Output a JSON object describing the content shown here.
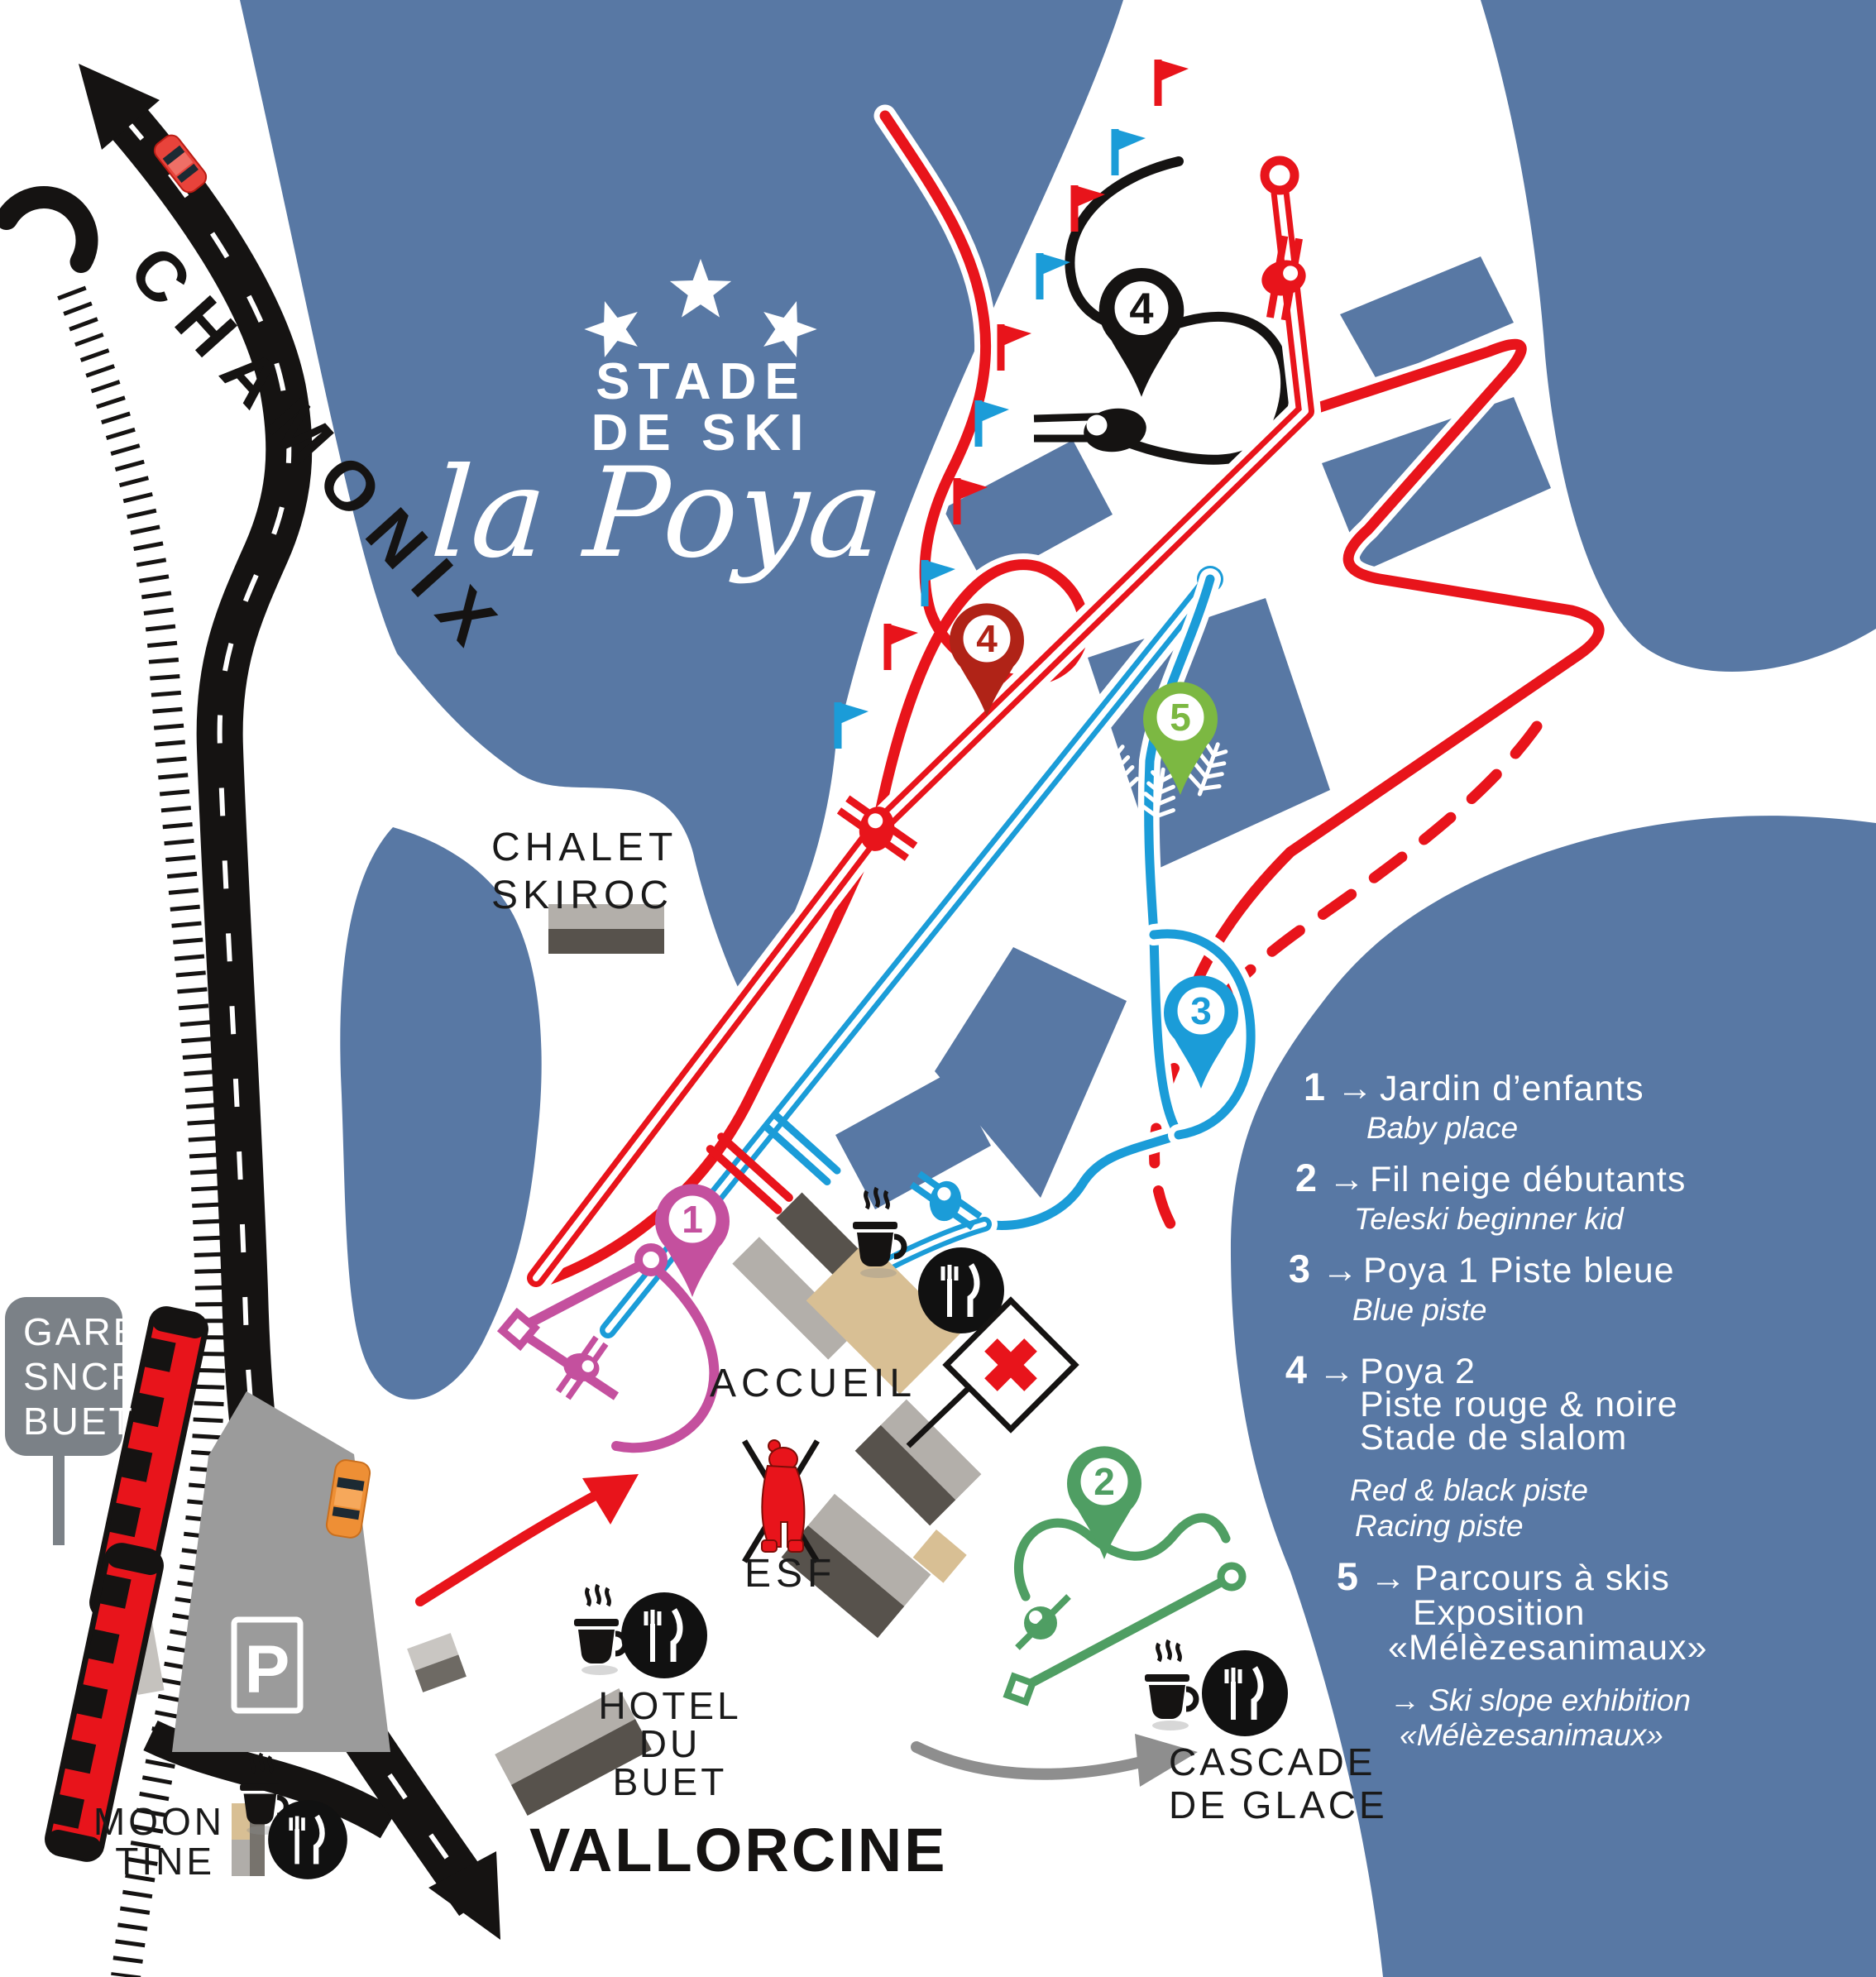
{
  "title": {
    "stars_count": "3",
    "line1": "STADE",
    "line2": "DE SKI",
    "script": "la Poya"
  },
  "nav": {
    "chamonix": "CHAMONIX",
    "vallorcine": "VALLORCINE"
  },
  "sign_gare": {
    "lines": [
      "GARE",
      "SNCF",
      "BUET"
    ]
  },
  "places": {
    "chalet_skiroc": {
      "line1": "CHALET",
      "line2": "SKIROC"
    },
    "accueil": "ACCUEIL",
    "esf": "ESF",
    "hotel_du_buet": {
      "line1": "HOTEL",
      "line2": "DU",
      "line3": "BUET"
    },
    "moontine": {
      "line1": "MOON",
      "line2": "TINE"
    },
    "cascade_de_glace": {
      "line1": "CASCADE",
      "line2": "DE GLACE"
    },
    "parking": "P"
  },
  "markers": {
    "m1": {
      "number": "1",
      "color": "#c4509e"
    },
    "m2": {
      "number": "2",
      "color": "#4f9e63"
    },
    "m3": {
      "number": "3",
      "color": "#1b9cd8"
    },
    "m4_red": {
      "number": "4",
      "color": "#b02317"
    },
    "m4_black": {
      "number": "4",
      "color": "#151312"
    },
    "m5": {
      "number": "5",
      "color": "#7cb842"
    }
  },
  "legend": {
    "arrow": "→",
    "items": [
      {
        "number": "1",
        "fr": [
          "Jardin d’enfants"
        ],
        "en": [
          "Baby place"
        ]
      },
      {
        "number": "2",
        "fr": [
          "Fil neige débutants"
        ],
        "en": [
          "Teleski beginner kid"
        ]
      },
      {
        "number": "3",
        "fr": [
          "Poya 1 Piste bleue"
        ],
        "en": [
          "Blue piste"
        ]
      },
      {
        "number": "4",
        "fr": [
          "Poya 2",
          "Piste rouge & noire",
          "Stade de slalom"
        ],
        "en": [
          "Red & black piste",
          "Racing piste"
        ]
      },
      {
        "number": "5",
        "fr": [
          "Parcours à skis",
          "Exposition",
          "«Mélèzesanimaux»"
        ],
        "en": [
          "→ Ski slope exhibition",
          "«Mélèzesanimaux»"
        ]
      }
    ]
  },
  "colors": {
    "background_blue": "#5878a4",
    "piste_red": "#e8141b",
    "piste_blue": "#1b9cd8",
    "piste_black": "#151312",
    "lift_magenta": "#c4509e",
    "lift_green": "#4f9e63",
    "road_black": "#151312",
    "parking_gray": "#9b9b9b",
    "sign_gray": "#7b8187",
    "arrow_gray": "#8e8e8e",
    "building_light": "#b3afaa",
    "building_dark": "#57524c",
    "building_tan": "#d8bf94",
    "train_red": "#e8141b"
  },
  "icons": {
    "tunnel-icon": "black-arc",
    "flag-icon": "slalom-pennant",
    "pylon-icon": "drag-lift-tower",
    "skis-icon": "parallel-skis",
    "cafe-icon": "coffee-cup-steam",
    "restaurant-icon": "fork-knife-circle",
    "first-aid-icon": "red-cross-flag",
    "esf-bear-icon": "red-bear-mascot",
    "tree-icon": "larch-branch",
    "car-icon": "car-top-view",
    "train-icon": "red-train",
    "parking-icon": "P-sign",
    "star-icon": "five-point-star"
  }
}
